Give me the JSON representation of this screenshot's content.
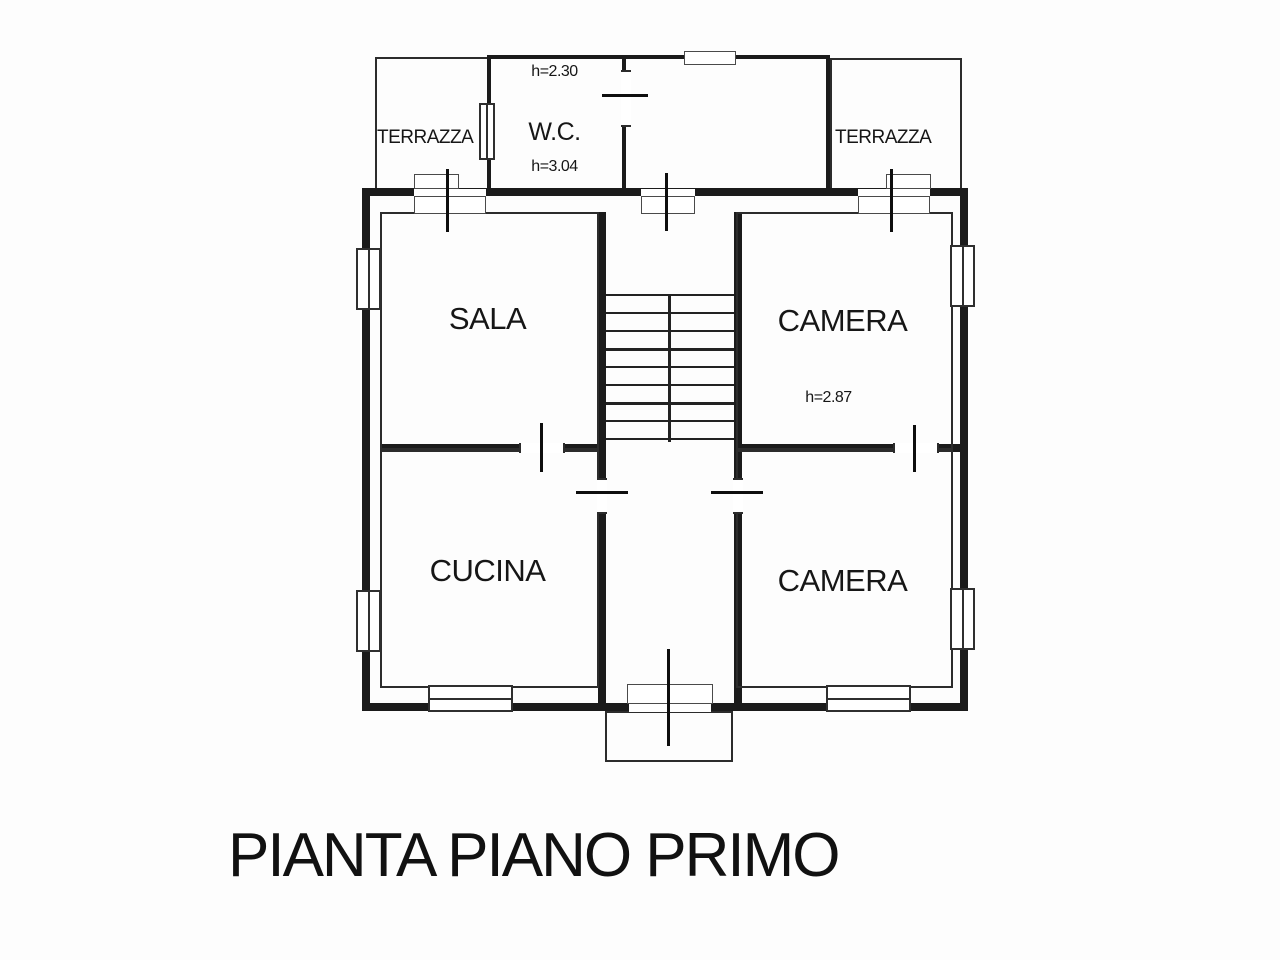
{
  "plan": {
    "title": "PIANTA PIANO PRIMO",
    "rooms": {
      "terrazza_left": {
        "label": "TERRAZZA"
      },
      "wc": {
        "label": "W.C.",
        "height_upper": "h=2.30",
        "height_lower": "h=3.04"
      },
      "terrazza_right": {
        "label": "TERRAZZA"
      },
      "sala": {
        "label": "SALA"
      },
      "camera_top": {
        "label": "CAMERA",
        "height": "h=2.87"
      },
      "cucina": {
        "label": "CUCINA"
      },
      "camera_bottom": {
        "label": "CAMERA"
      }
    },
    "colors": {
      "line": "#1b1b1b",
      "background": "#ffffff"
    }
  }
}
